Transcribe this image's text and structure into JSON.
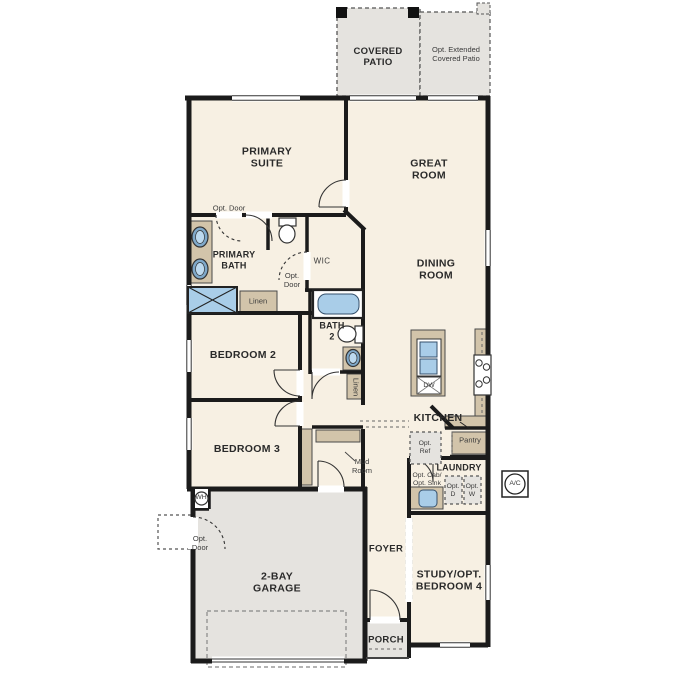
{
  "plan": {
    "type": "single-story residential floor plan",
    "labels": {
      "covered_patio": "COVERED\nPATIO",
      "opt_extended_patio": "Opt. Extended\nCovered Patio",
      "primary_suite": "PRIMARY\nSUITE",
      "great_room": "GREAT\nROOM",
      "dining_room": "DINING\nROOM",
      "opt_door_primary": "Opt. Door",
      "primary_bath": "PRIMARY\nBATH",
      "wic": "WIC",
      "opt_door_wic": "Opt.\nDoor",
      "linen_primary": "Linen",
      "bath_2": "BATH\n2",
      "linen_hall": "Linen",
      "bedroom_2": "BEDROOM 2",
      "bedroom_3": "BEDROOM 3",
      "kitchen": "KITCHEN",
      "dw": "DW",
      "opt_ref": "Opt.\nRef",
      "pantry": "Pantry",
      "laundry": "LAUNDRY",
      "opt_cab_sink": "Opt. Cab/\nOpt. Sink",
      "opt_d": "Opt.\nD",
      "opt_w": "Opt.\nW",
      "ac": "A/C",
      "mud_room": "Mud\nRoom",
      "wh": "WH",
      "opt_door_garage": "Opt.\nDoor",
      "garage": "2-BAY\nGARAGE",
      "foyer": "FOYER",
      "study": "STUDY/OPT.\nBEDROOM 4",
      "porch": "PORCH"
    },
    "colors": {
      "floor": "#f7f0e3",
      "outdoor": "#e5e3df",
      "cabinet": "#d2c4aa",
      "fixture_blue": "#a9cde8",
      "wall": "#1b1b1b",
      "dashed": "#666666",
      "text": "#2a2a2a"
    }
  }
}
